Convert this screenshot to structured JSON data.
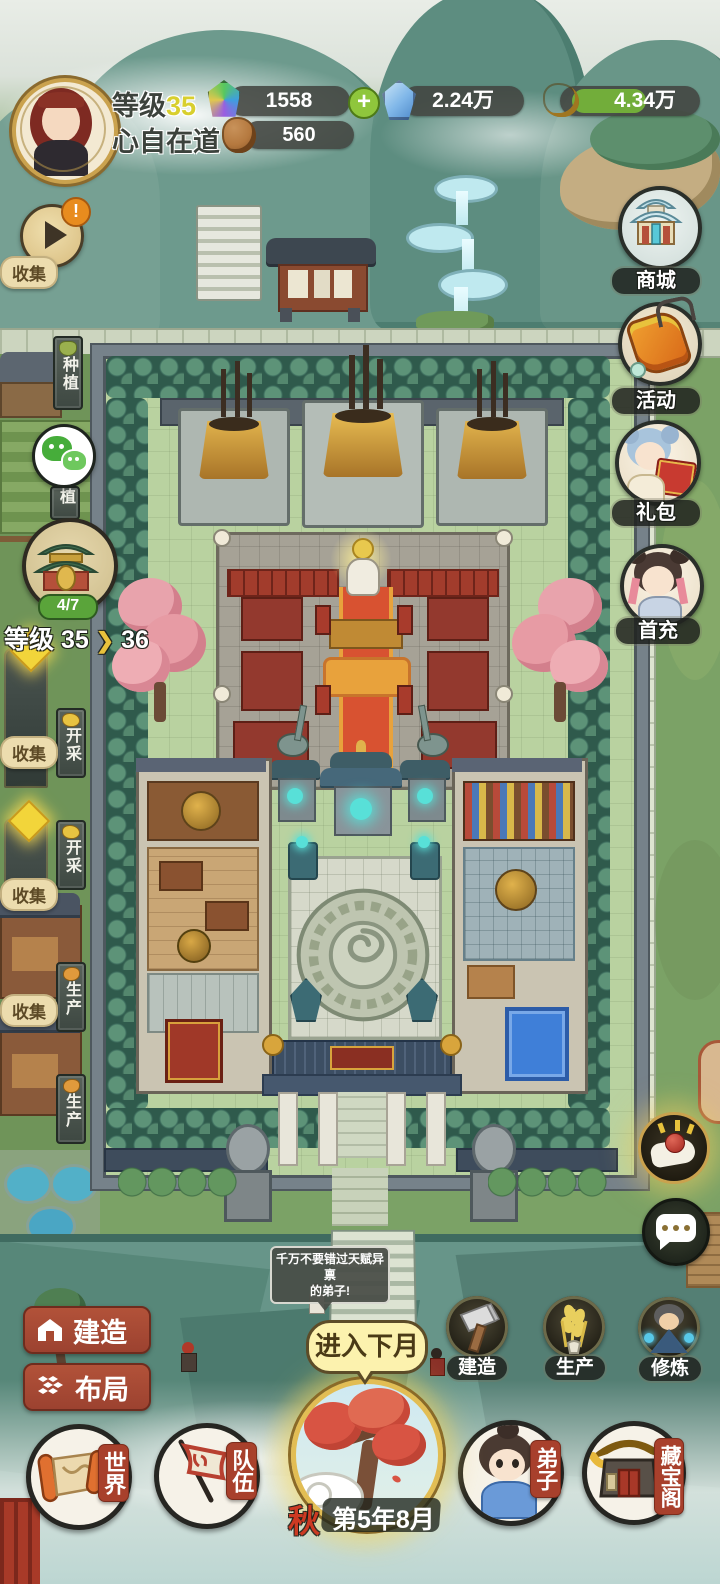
{
  "player": {
    "level_label": "等级",
    "level": "35",
    "name": "心自在道"
  },
  "resources": {
    "gem": {
      "value": "1558"
    },
    "gem_add": "+",
    "crystal": {
      "value": "2.24万"
    },
    "gold": {
      "value": "4.34万"
    },
    "clay": {
      "value": "560"
    }
  },
  "alerts": {
    "play_badge": "!"
  },
  "left_hud": {
    "collect_1": "收集",
    "collect_2": "收集",
    "collect_3": "收集",
    "collect_4": "收集",
    "sign_plant": "种植",
    "sign_plant_partial": "植",
    "sign_mine_1": "开采",
    "sign_mine_2": "开采",
    "sign_produce_1": "生产",
    "sign_produce_2": "生产",
    "sect": {
      "badge": "4/7",
      "level_label": "等级",
      "level_from": "35",
      "arrow": "❯",
      "level_to": "36"
    }
  },
  "right_hud": {
    "shop": "商城",
    "events": "活动",
    "gift": "礼包",
    "first_charge": "首充"
  },
  "npc": {
    "bubble_line1": "千万不要错过天赋异禀",
    "bubble_line2": "的弟子!"
  },
  "bottom_left": {
    "build": "建造",
    "layout": "布局"
  },
  "month": {
    "cta": "进入下月",
    "season": "秋",
    "date": "第5年8月"
  },
  "quick_actions": {
    "build": "建造",
    "produce": "生产",
    "cultivate": "修炼"
  },
  "bottom_nav": {
    "world": "世界",
    "team": "队伍",
    "disciple": "弟子",
    "treasure": "藏宝阁"
  }
}
